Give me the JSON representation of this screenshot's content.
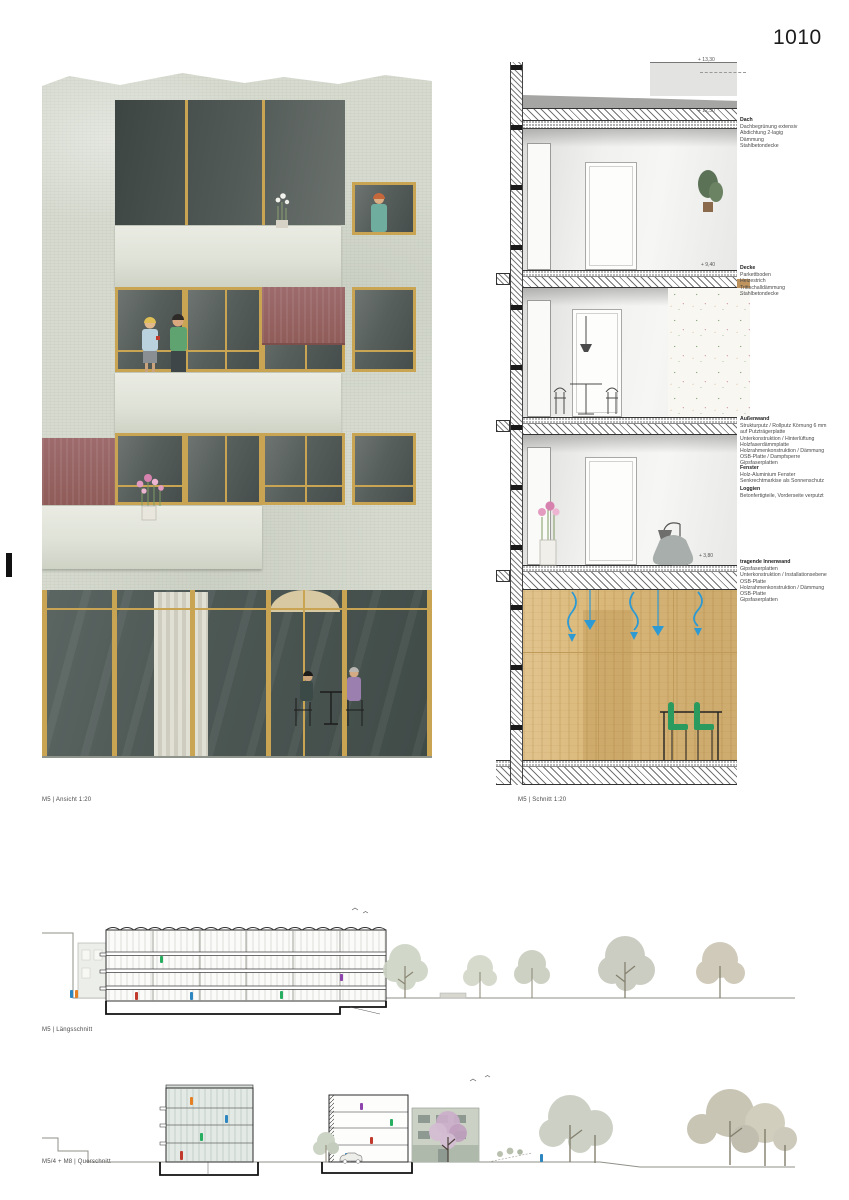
{
  "page": {
    "number": "1010"
  },
  "captions": {
    "ansicht": "M5 | Ansicht 1:20",
    "schnitt": "M5 | Schnitt 1:20",
    "laengsschnitt": "M5 | Längsschnitt",
    "querschnitt": "M5/4 + M8 | Querschnitt"
  },
  "section": {
    "markers": [
      "+ 13,30",
      "+ 12,50",
      "+ 9,40",
      "+ 3,80"
    ]
  },
  "annotations": [
    {
      "title": "Dach",
      "lines": [
        "Dachbegrünung extensiv",
        "Abdichtung 2-lagig",
        "Dämmung",
        "Stahlbetondecke"
      ]
    },
    {
      "title": "Decke",
      "lines": [
        "Parkettboden",
        "Heizestrich",
        "Trittschalldämmung",
        "Stahlbetondecke"
      ]
    },
    {
      "title": "Außenwand",
      "lines": [
        "Strukturputz / Rollputz Körnung 6 mm",
        "auf Putzträgerplatte",
        "Unterkonstruktion / Hinterlüftung",
        "Holzfaserdämmplatte",
        "Holzrahmenkonstruktion / Dämmung",
        "OSB-Platte / Dampfsperre",
        "Gipsfaserplatten"
      ]
    },
    {
      "title": "Fenster",
      "lines": [
        "Holz-Aluminium Fenster",
        "Senkrechtmarkise als Sonnenschutz"
      ]
    },
    {
      "title": "Loggien",
      "lines": [
        "Betonfertigteile, Vorderseite verputzt"
      ]
    },
    {
      "title": "tragende Innenwand",
      "lines": [
        "Gipsfaserplatten",
        "Unterkonstruktion / Installationsebene",
        "OSB-Platte",
        "Holzrahmenkonstruktion / Dämmung",
        "OSB-Platte",
        "Gipsfaserplatten"
      ]
    }
  ],
  "colors": {
    "stucco": "#d6dacf",
    "wood": "#c9a452",
    "awning": "#9e6b6d",
    "plywood": "#dcba7c",
    "duct-blue": "#2e9ad3",
    "chair-green": "#2a9a5f"
  }
}
